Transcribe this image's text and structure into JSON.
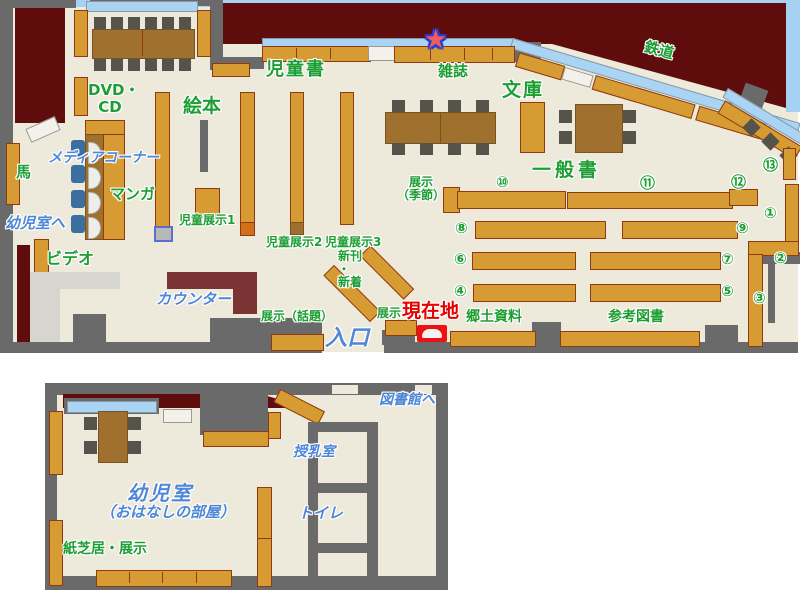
{
  "palette": {
    "floor": "#edeadb",
    "wall": "#6a6a6a",
    "maroon": "#5e0c0c",
    "shelf": "#d79b33",
    "shelf-border": "#8f3a10",
    "shelf-cap": "#d2701a",
    "window": "#a9d4f3",
    "sky": "#a5d1f2",
    "table": "#a0702f",
    "chair": "#55534a",
    "blue-chair": "#3b6f9f",
    "counter": "#7a3434",
    "counter-light": "#d6d5d0",
    "green": "#1d9e33",
    "blue": "#4e86d8",
    "red": "#e60000",
    "marker": "#ee1111"
  },
  "main_floor": {
    "labels": {
      "dvd_cd": "DVD・\nCD",
      "ehon": "絵本",
      "jidosho": "児童書",
      "zasshi": "雑誌",
      "bunko": "文庫",
      "tetsudo": "鉄道",
      "ippansho": "一般書",
      "uma": "馬",
      "manga": "マンガ",
      "video": "ビデオ",
      "media_corner": "メディアコーナー",
      "yojishitsu_e": "幼児室へ",
      "counter": "カウンター",
      "jido_tenji1": "児童展示1",
      "jido_tenji2": "児童展示2",
      "jido_tenji3": "児童展示3",
      "shinkan_shinchaku": "新刊\n ・\n  新着",
      "tenji_wadai": "展示（話題）",
      "tenji": "展示",
      "tenji_kisetsu": "展示\n（季節）",
      "genzaichi": "現在地",
      "iriguchi": "入口",
      "kyodo_shiryo": "郷土資料",
      "sanko_tosho": "参考図書"
    },
    "star_icon": "★",
    "shelf_numbers": [
      "①",
      "②",
      "③",
      "④",
      "⑤",
      "⑥",
      "⑦",
      "⑧",
      "⑨",
      "⑩",
      "⑪",
      "⑫",
      "⑬"
    ]
  },
  "annex": {
    "labels": {
      "toshokan_e": "図書館へ",
      "junyushitsu": "授乳室",
      "toilet": "トイレ",
      "yojishitsu": "幼児室",
      "ohanashi": "（おはなしの部屋）",
      "kamishibai": "紙芝居・展示"
    }
  }
}
